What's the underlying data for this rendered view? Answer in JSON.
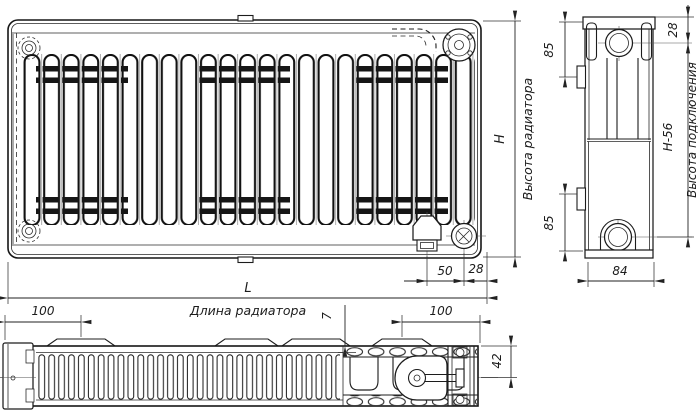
{
  "diagram": {
    "type": "technical-drawing",
    "subject": "panel radiator dimensional drawing, three views",
    "dimensions": {
      "h": "H",
      "h56": "H-56",
      "l": "L",
      "d85_top": "85",
      "d85_bottom": "85",
      "d28_side": "28",
      "d28_front": "28",
      "d50": "50",
      "d84": "84",
      "d100_left": "100",
      "d100_right": "100",
      "d7": "7",
      "d42": "42"
    },
    "captions": {
      "height": "Высота радиатора",
      "connection_height": "Высота подключения",
      "length": "Длина радиатора"
    },
    "colors": {
      "line": "#1c1c1c",
      "background": "#ffffff"
    }
  }
}
